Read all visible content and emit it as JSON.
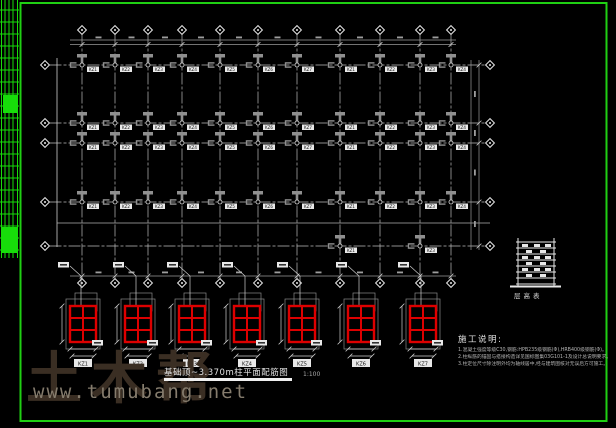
{
  "colors": {
    "frame": "#1fcf13",
    "ladder": "#17dd0a",
    "axis": "#bdbdbd",
    "line": "#cfcfcf",
    "dim": "#9a9a9a",
    "gray_fill": "#8f8f8f",
    "white": "#e8e8e8",
    "tagbox": "#e8e8e8",
    "tagtext": "#111111",
    "red": "#dd0000"
  },
  "watermark": {
    "brand": "土木帮",
    "url": "www.tumubang.net"
  },
  "title_block": {
    "title": "基础顶~3.370m柱平面配筋图",
    "scale": "1:100"
  },
  "notes": {
    "heading": "施工说明:",
    "items": [
      "1.混凝土强度等级C30,钢筋:HPB235级钢筋(Φ),HRB400级钢筋(Φ)。",
      "2.柱纵筋的锚固与搭接构造详见国标图集03G101-1及设计总说明要求。",
      "3.柱定位尺寸除注明外均为轴线居中,经与建筑图核对无误后方可施工。"
    ]
  },
  "legend": {
    "caption": "层高表"
  },
  "plan": {
    "column_tags": [
      "KZ1",
      "KZ2",
      "KZ3",
      "KZ4",
      "KZ5",
      "KZ6",
      "KZ7"
    ]
  },
  "details": {
    "items": [
      {
        "tag": "KZ1"
      },
      {
        "tag": "KZ2"
      },
      {
        "tag": "KZ3"
      },
      {
        "tag": "KZ4"
      },
      {
        "tag": "KZ5"
      },
      {
        "tag": "KZ6"
      },
      {
        "tag": "KZ7"
      }
    ]
  }
}
